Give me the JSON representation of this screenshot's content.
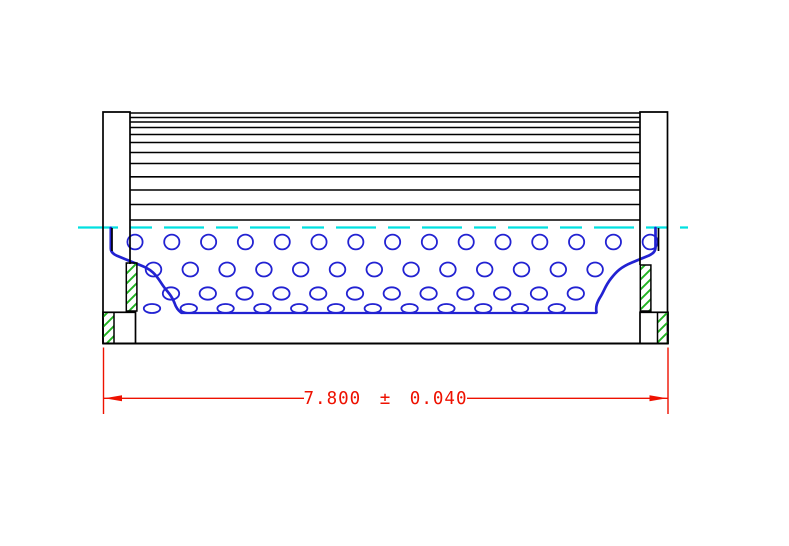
{
  "drawing": {
    "dimension": {
      "label": "7.800 ± 0.040",
      "nominal": "7.800",
      "tolerance": "0.040"
    },
    "colors": {
      "outline": "#000000",
      "core_blue": "#2222d2",
      "hatch_green": "#22b422",
      "centerline_cyan": "#00e0e0",
      "dimension_red": "#ee1100"
    },
    "pleat_extent": {
      "x1": 130,
      "x2": 640
    },
    "pleat_lines_y": [
      113,
      117.5,
      122,
      127.5,
      134.5,
      142.5,
      152.5,
      163.5,
      176.8,
      190,
      204.5,
      220
    ],
    "hole_rows": [
      {
        "y": 242,
        "rx": 7.6,
        "ry": 7.4,
        "x_start": 135,
        "pitch": 36.8,
        "count": 15
      },
      {
        "y": 269.5,
        "rx": 7.8,
        "ry": 7.0,
        "x_start": 153.5,
        "pitch": 36.8,
        "count": 13
      },
      {
        "y": 293.5,
        "rx": 8.2,
        "ry": 6.2,
        "x_start": 171,
        "pitch": 36.8,
        "count": 12
      },
      {
        "y": 308.5,
        "rx": 8.2,
        "ry": 4.5,
        "x_start": 152,
        "pitch": 36.8,
        "count": 12
      }
    ]
  }
}
